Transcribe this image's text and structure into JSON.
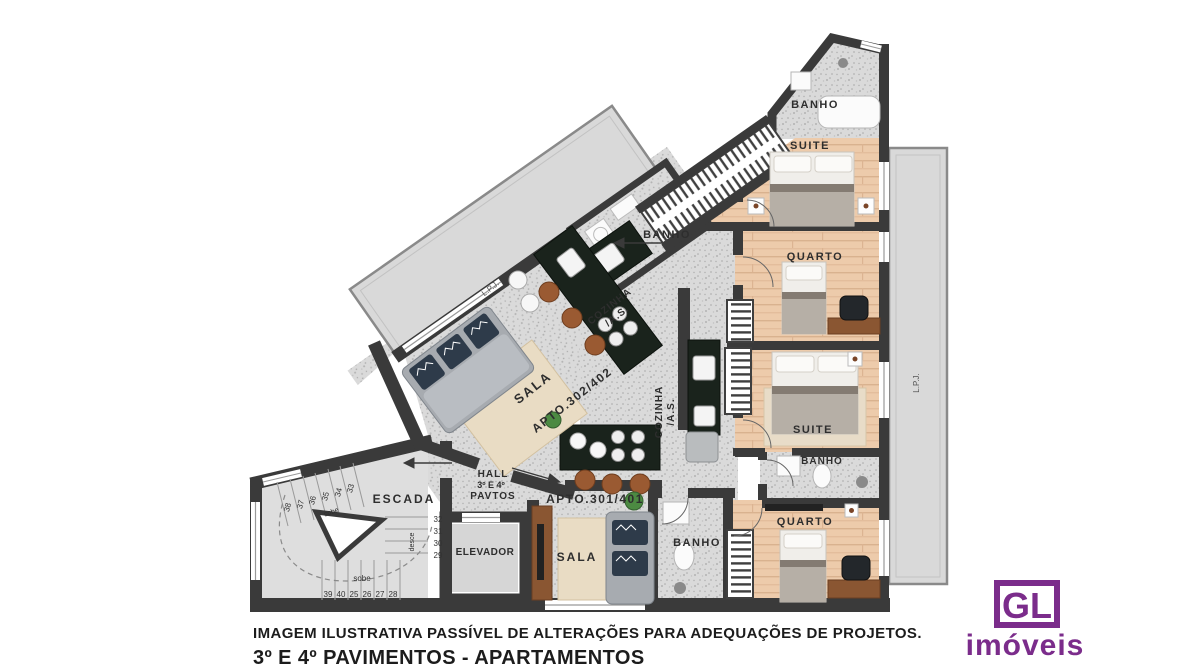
{
  "title_block": {
    "line1": "IMAGEM ILUSTRATIVA PASSÍVEL DE ALTERAÇÕES PARA ADEQUAÇÕES DE PROJETOS.",
    "line2": "3º E 4º PAVIMENTOS - APARTAMENTOS"
  },
  "logo": {
    "monogram": "GL",
    "name": "imóveis",
    "color": "#7b2c8b"
  },
  "apartments": {
    "apt_301": "APTO.301/401",
    "apt_302": "APTO.302/402"
  },
  "rooms": {
    "banho": "BANHO",
    "suite": "SUITE",
    "quarto": "QUARTO",
    "sala": "SALA",
    "cozinha": "COZINHA",
    "area_servico": "/A.S.",
    "hall_line1": "HALL",
    "hall_line2": "3º E 4º",
    "hall_line3": "PAVTOS",
    "escada": "ESCADA",
    "elevador": "ELEVADOR",
    "lpj": "L.P.J."
  },
  "stairs": {
    "sobe": "sobe",
    "desce": "desce",
    "steps_bottom": [
      "39",
      "40",
      "25",
      "26",
      "27",
      "28"
    ],
    "steps_right": [
      "32",
      "31",
      "30",
      "29"
    ],
    "steps_diagonal": [
      "38",
      "37",
      "36",
      "35",
      "34",
      "33"
    ]
  },
  "colors": {
    "wall": "#3a3a3a",
    "wood_floor": "#edcbab",
    "granite_floor": "#dadada",
    "stair_floor": "#dedede",
    "terrace": "#d9d9d9",
    "counter": "#1a231c",
    "logo_purple": "#7b2c8b"
  }
}
